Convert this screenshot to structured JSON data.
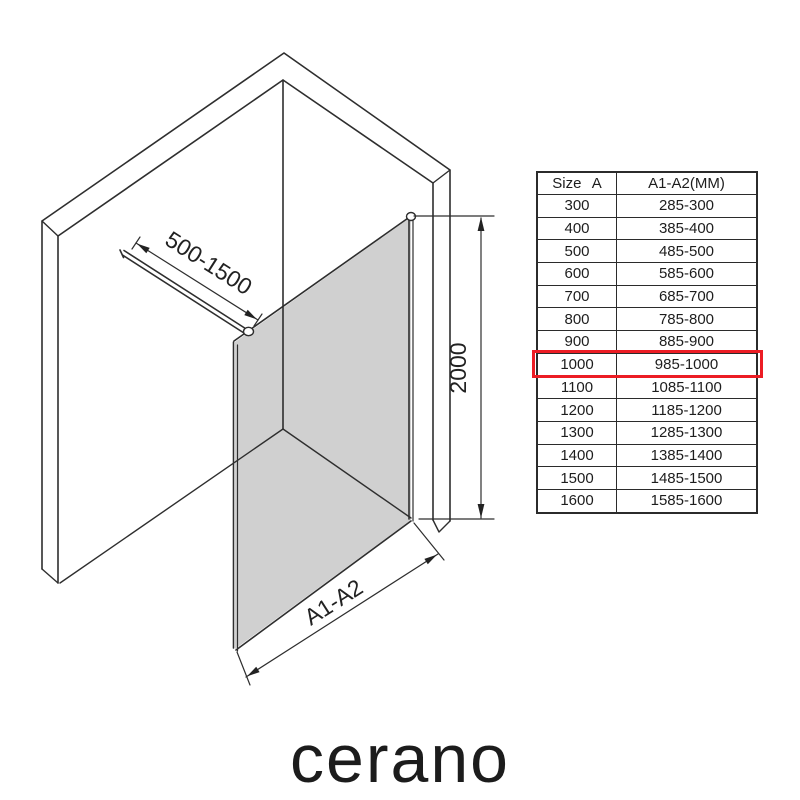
{
  "diagram": {
    "bar_dimension": "500-1500",
    "height_dimension": "2000",
    "width_dimension": "A1-A2",
    "glass_color": "#c8c8c8",
    "line_color": "#2e2e2e"
  },
  "spec_table": {
    "headers": [
      "Size A",
      "A1-A2(MM)"
    ],
    "rows": [
      {
        "size": "300",
        "range": "285-300"
      },
      {
        "size": "400",
        "range": "385-400"
      },
      {
        "size": "500",
        "range": "485-500"
      },
      {
        "size": "600",
        "range": "585-600"
      },
      {
        "size": "700",
        "range": "685-700"
      },
      {
        "size": "800",
        "range": "785-800"
      },
      {
        "size": "900",
        "range": "885-900"
      },
      {
        "size": "1000",
        "range": "985-1000"
      },
      {
        "size": "1100",
        "range": "1085-1100"
      },
      {
        "size": "1200",
        "range": "1185-1200"
      },
      {
        "size": "1300",
        "range": "1285-1300"
      },
      {
        "size": "1400",
        "range": "1385-1400"
      },
      {
        "size": "1500",
        "range": "1485-1500"
      },
      {
        "size": "1600",
        "range": "1585-1600"
      }
    ],
    "highlighted_size": "1000",
    "highlight_color": "#ec1c24"
  },
  "brand": {
    "logo": "cerano"
  }
}
